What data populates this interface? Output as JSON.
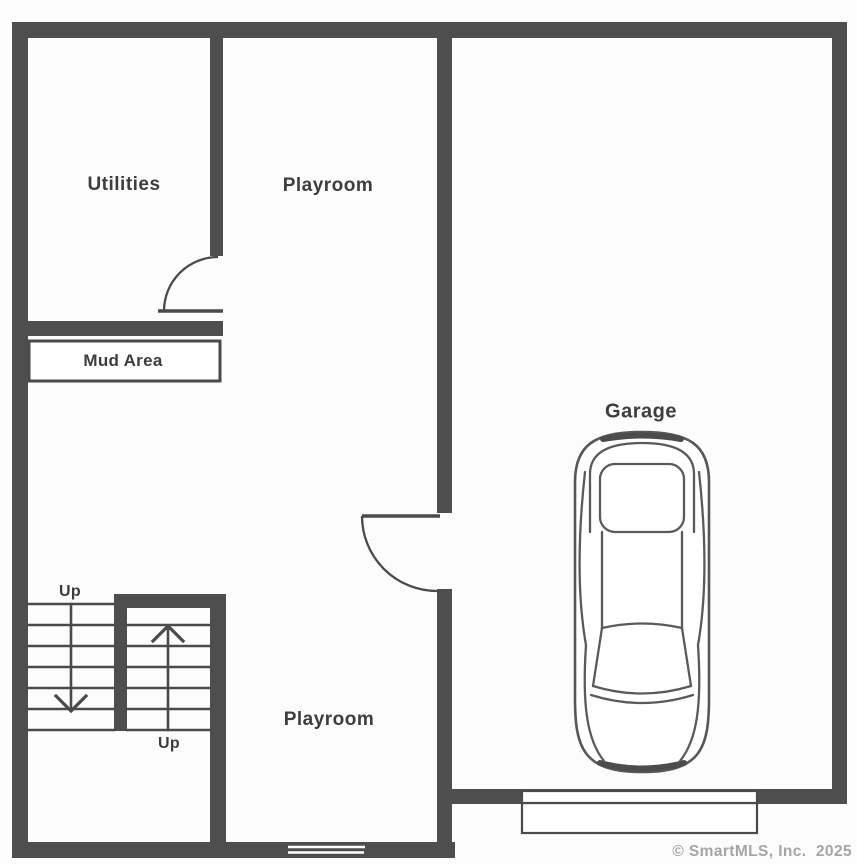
{
  "rooms": {
    "utilities": "Utilities",
    "playroom_upper": "Playroom",
    "playroom_lower": "Playroom",
    "mud_area": "Mud Area",
    "garage": "Garage"
  },
  "stairs": {
    "up_label_upper": "Up",
    "up_label_lower": "Up"
  },
  "watermark": {
    "text": "© SmartMLS, Inc.  2025"
  },
  "icons": {
    "car": "car-top-view-icon",
    "stairs_up_arrow": "arrow-up-icon",
    "stairs_down_arrow": "arrow-down-icon",
    "doors": "door-swing-arc-icon"
  },
  "colors": {
    "wall": "#4e4e4e",
    "line": "#4a4a4a",
    "label_text": "#3d3d3d",
    "watermark_text": "#a5a5a5",
    "background": "#fcfcfc"
  }
}
